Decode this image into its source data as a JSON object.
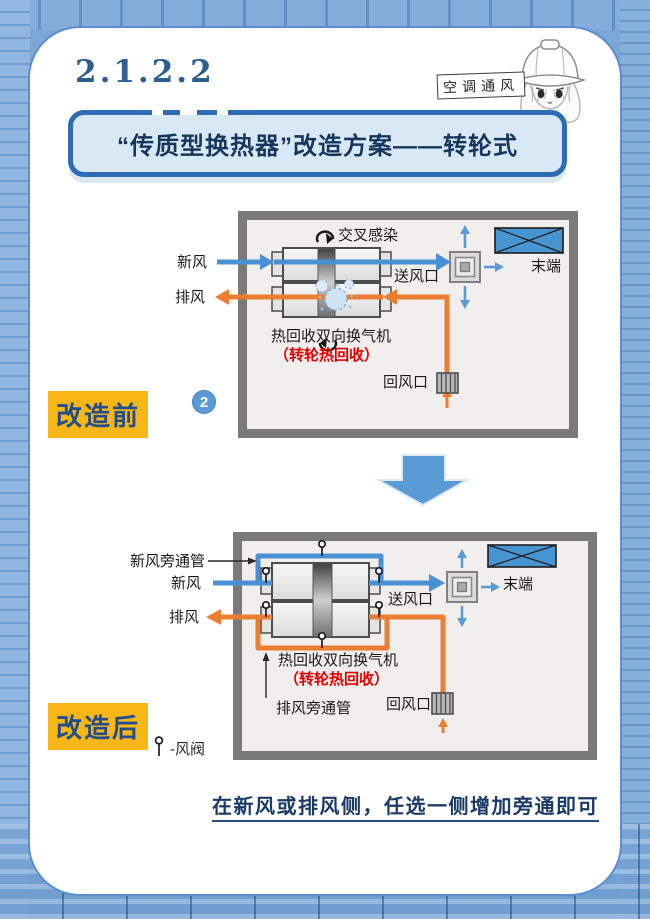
{
  "header": {
    "section_number": "2.1.2.2",
    "mascot_caption": "空调通风",
    "title": "“传质型换热器”改造方案——转轮式"
  },
  "diagram_before": {
    "stage_label": "改造前",
    "badge": "2",
    "labels": {
      "cross_infection": "交叉感染",
      "fresh_air": "新风",
      "exhaust_air": "排风",
      "supply_outlet": "送风口",
      "terminal": "末端",
      "unit_name": "热回收双向换气机",
      "unit_subtitle": "（转轮热回收）",
      "return_inlet": "回风口"
    }
  },
  "diagram_after": {
    "stage_label": "改造后",
    "labels": {
      "fresh_air_bypass": "新风旁通管",
      "fresh_air": "新风",
      "exhaust_air": "排风",
      "supply_outlet": "送风口",
      "terminal": "末端",
      "unit_name": "热回收双向换气机",
      "unit_subtitle": "（转轮热回收）",
      "exhaust_bypass": "排风旁通管",
      "return_inlet": "回风口"
    },
    "legend_valve": "-风阀"
  },
  "footer": {
    "note": "在新风或排风侧，任选一侧增加旁通即可"
  },
  "colors": {
    "background_blue": "#7ba6d6",
    "card_white": "#ffffff",
    "banner_border_blue": "#2e6cb5",
    "banner_fill": "#d9e8f5",
    "navy_text": "#16365c",
    "highlight_yellow": "#f8b717",
    "fresh_air_blue": "#4a90d5",
    "exhaust_orange": "#ed7d31",
    "alert_red": "#e50000",
    "room_gray": "#7a7a7a",
    "terminal_blue": "#4694d1",
    "badge_blue": "#5b9bd5"
  }
}
